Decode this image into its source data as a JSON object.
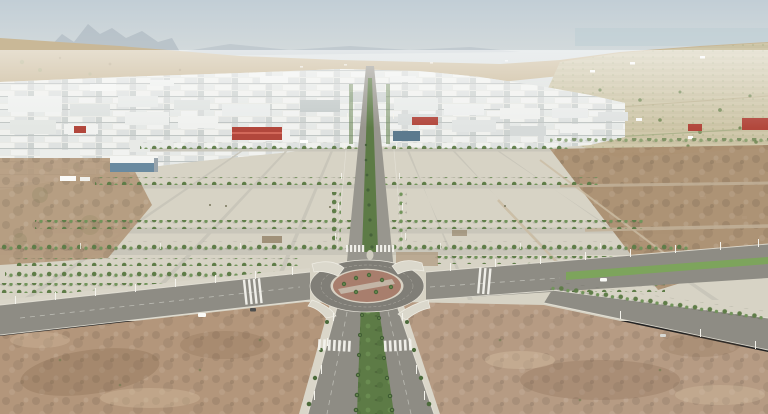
{
  "meta": {
    "type": "aerial-drone-photograph",
    "description": "Aerial view of a newly urbanised industrial park: central palm-lined boulevard leading to a roundabout, vacant serviced plots with rows of young trees, white warehouse district behind, semi-arid hills, faint mountains and hazy coast on the horizon, undeveloped scrubland in the foreground corners."
  },
  "palette": {
    "sky_top": "#c2ced6",
    "sky_horizon": "#e8e9e3",
    "sea": "#bccdd3",
    "mountain": "#a3b0ba",
    "hill": "#c9b897",
    "field": "#d2caad",
    "field_green": "#9fae7e",
    "industrial": "#e8e9e5",
    "roof_red": "#b2473c",
    "roof_ridge": "#d2685a",
    "glass_blue": "#5c7a8e",
    "showroom_glass": "#6a8aa0",
    "plots": "#d7d3c5",
    "street": "#c8c5b9",
    "road": "#8e8c84",
    "road_far": "#98968e",
    "road_dark": "#807e77",
    "curb": "#eceadf",
    "sidewalk": "#dad6c9",
    "tree": "#5f7d48",
    "tree_light": "#71945a",
    "median_green": "#5d7b46",
    "grass": "#7da45c",
    "roundabout_center": "#a87e6d",
    "roundabout_path": "#c8beb0",
    "island": "#dbd8cc",
    "dirt_sw": "#b3967b",
    "dirt_se": "#b69b83",
    "dirt_plots_east": "#a98d6e",
    "dirt_plots_west": "#b29679",
    "debris": "#8d7b5f",
    "pole": "#f4f3ec",
    "vehicle_white": "#fafaf6",
    "vehicle_dark": "#4f4f4d"
  }
}
